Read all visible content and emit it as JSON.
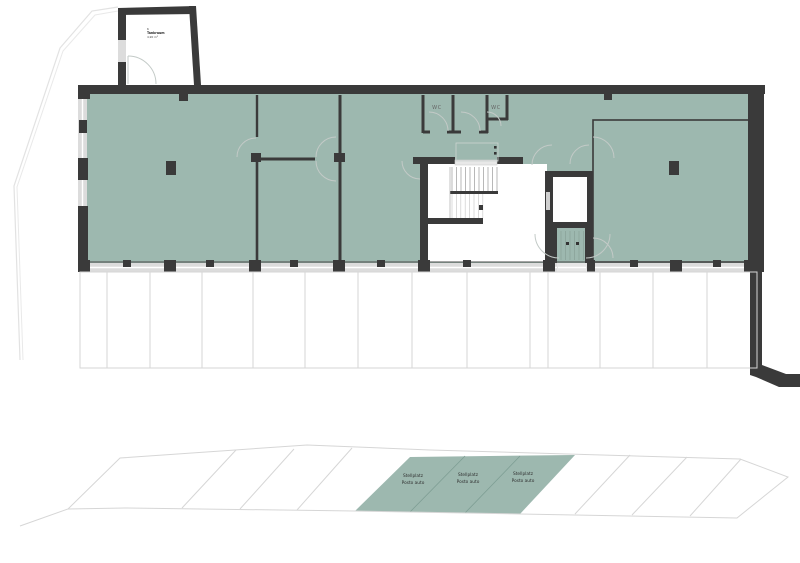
{
  "colors": {
    "room_fill": "#9db8af",
    "wall": "#3a3a3a",
    "stall_divider": "#7e9e94"
  },
  "annex_label": {
    "number": "6",
    "name": "Tankraum",
    "area": "4,90 m²"
  },
  "wc_labels": {
    "left": "WC",
    "right": "WC"
  },
  "parking_stalls": [
    {
      "line1": "Stellplatz",
      "line2": "Posto auto"
    },
    {
      "line1": "Stellplatz",
      "line2": "Posto auto"
    },
    {
      "line1": "Stellplatz",
      "line2": "Posto auto"
    }
  ]
}
